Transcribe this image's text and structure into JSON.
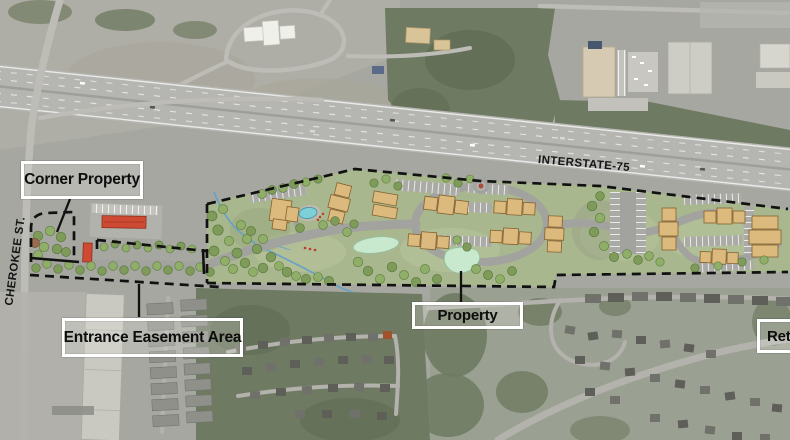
{
  "labels": {
    "corner_property": "Corner Property",
    "entrance_easement_area": "Entrance Easement Area",
    "property": "Property",
    "retail": "Retail",
    "interstate": "INTERSTATE-75",
    "cherokee_street": "CHEROKEE ST."
  },
  "colors": {
    "boundary_dash": "#111111",
    "label_border": "#ffffff",
    "label_text": "#0d0d0d",
    "plan_green": "#a9b78e",
    "building_tan": "#dcba7e",
    "road_gray": "#a2a29e",
    "pool_blue": "#7cd0d6",
    "pond_green": "#c9e9cf",
    "accent_red": "#cf4a33",
    "tree_green": "#7e9b5a"
  }
}
